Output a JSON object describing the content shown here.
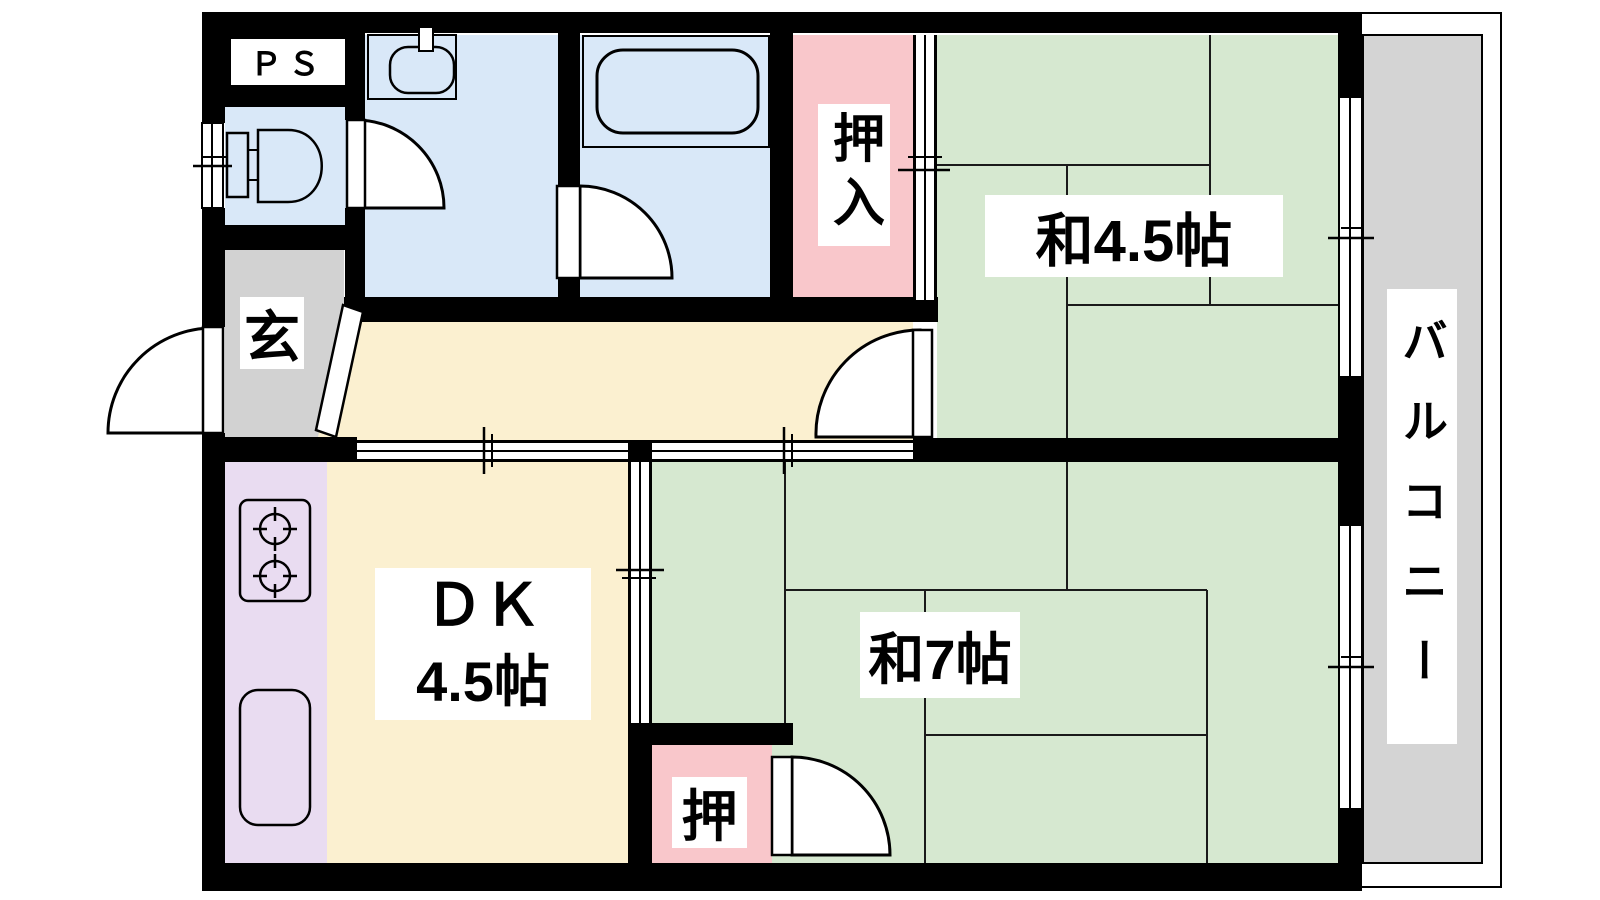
{
  "title": "2DK apartment floor plan",
  "labels": {
    "ps": "ＰＳ",
    "entrance": "玄",
    "closet": "押入",
    "closet_small": "押",
    "room_45": "和4.5帖",
    "room_7": "和7帖",
    "dk_name": "ＤＫ",
    "dk_size": "4.5帖",
    "balcony": "バルコニー"
  },
  "rooms": [
    {
      "id": "japanese-room-4-5",
      "label": "和4.5帖",
      "type": "tatami room"
    },
    {
      "id": "japanese-room-7",
      "label": "和7帖",
      "type": "tatami room"
    },
    {
      "id": "dining-kitchen",
      "label": "ＤＫ 4.5帖",
      "type": "dining kitchen"
    },
    {
      "id": "closet-oshiire",
      "label": "押入",
      "type": "closet"
    },
    {
      "id": "closet-oshi",
      "label": "押",
      "type": "closet"
    },
    {
      "id": "entrance-genkan",
      "label": "玄",
      "type": "entrance"
    },
    {
      "id": "pipe-space",
      "label": "ＰＳ",
      "type": "pipe space"
    },
    {
      "id": "balcony",
      "label": "バルコニー",
      "type": "balcony"
    }
  ],
  "colors": {
    "tatami_room": "#d6e8d0",
    "dk_floor": "#fbf0d0",
    "kitchen": "#e9dcf1",
    "wet_area": "#d9e8f8",
    "closet": "#f9c7cb",
    "entrance_floor": "#d2d2d2",
    "balcony_floor": "#d4d4d4",
    "wall": "#000000"
  }
}
